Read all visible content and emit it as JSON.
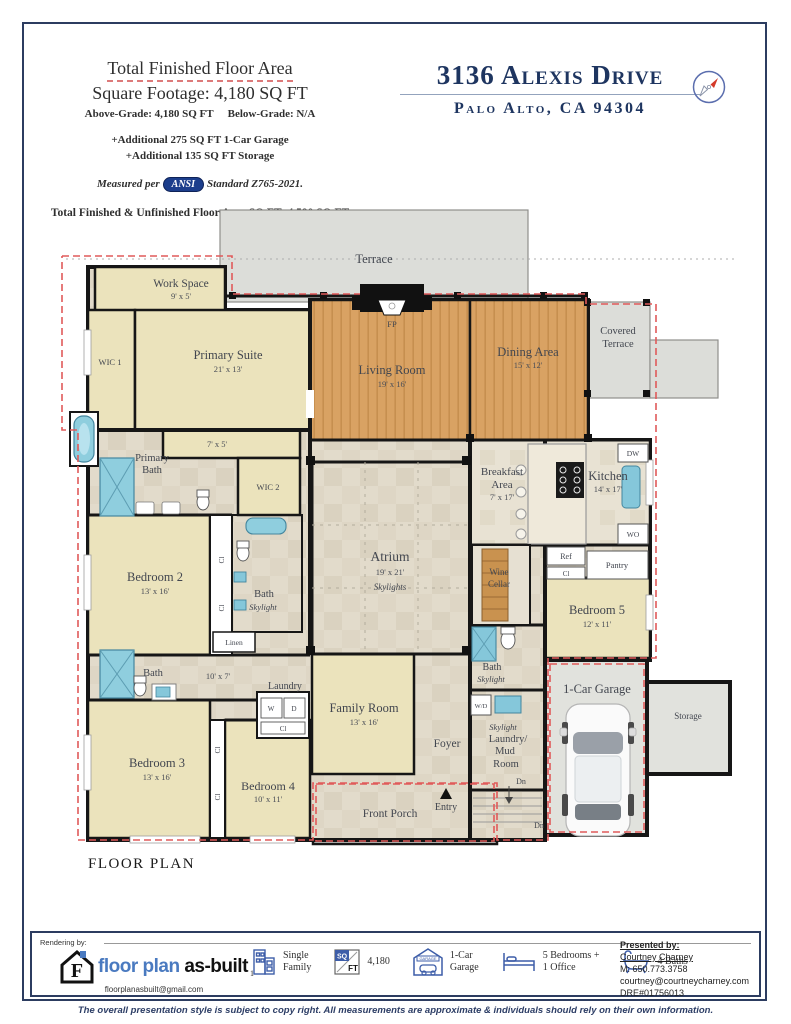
{
  "header": {
    "area_title": "Total Finished Floor Area",
    "area_value": "Square Footage: 4,180 SQ FT",
    "grade_above": "Above-Grade: 4,180 SQ FT",
    "grade_below": "Below-Grade: N/A",
    "additional_1": "+Additional 275 SQ FT 1-Car Garage",
    "additional_2": "+Additional 135 SQ FT Storage",
    "measured_prefix": "Measured per",
    "ansi": "ANSI",
    "measured_suffix": "Standard Z765-2021.",
    "total_line": "Total Finished & Unfinished Floor Area SQ FT: 4,590 SQ FT",
    "address": "3136 Alexis Drive",
    "city": "Palo Alto, CA 94304"
  },
  "plan": {
    "label": "FLOOR PLAN",
    "rooms": {
      "terrace": "Terrace",
      "covered1": "Covered",
      "covered2": "Terrace",
      "work": {
        "n": "Work Space",
        "d": "9' x 5'"
      },
      "wic1": "WIC 1",
      "primary": {
        "n": "Primary Suite",
        "d": "21' x 13'"
      },
      "living": {
        "n": "Living Room",
        "d": "19' x 16'"
      },
      "dining": {
        "n": "Dining Area",
        "d": "15' x 12'"
      },
      "fp": "FP",
      "pbath1": "Primary",
      "pbath2": "Bath",
      "hall75": "7' x 5'",
      "wic2": "WIC 2",
      "bed2": {
        "n": "Bedroom 2",
        "d": "13' x 16'"
      },
      "bathc1": "Bath",
      "bathc2": "Skylight",
      "linen": "Linen",
      "bathl": "Bath",
      "hall107": "10' x 7'",
      "laundry": "Laundry",
      "w": "W",
      "d": "D",
      "cl": "Cl",
      "bed3": {
        "n": "Bedroom 3",
        "d": "13' x 16'"
      },
      "bed4": {
        "n": "Bedroom 4",
        "d": "10' x 11'"
      },
      "family": {
        "n": "Family Room",
        "d": "13' x 16'"
      },
      "foyer": "Foyer",
      "porch": "Front Porch",
      "entry": "Entry",
      "atrium": {
        "n": "Atrium",
        "d": "19' x 21'",
        "s": "Skylights"
      },
      "breakfast": {
        "n1": "Breakfast",
        "n2": "Area",
        "d": "7' x 17'"
      },
      "kitchen": {
        "n": "Kitchen",
        "d": "14' x 17'"
      },
      "dw": "DW",
      "wo": "WO",
      "ref": "Ref",
      "pantry": "Pantry",
      "wine1": "Wine",
      "wine2": "Cellar",
      "bed5": {
        "n": "Bedroom 5",
        "d": "12' x 11'"
      },
      "bathr1": "Bath",
      "bathr2": "Skylight",
      "wd": "W/D",
      "mud": {
        "s": "Skylight",
        "l1": "Laundry/",
        "l2": "Mud",
        "l3": "Room"
      },
      "dn": "Dn",
      "garage": "1-Car Garage",
      "storage": "Storage"
    }
  },
  "footer": {
    "rendering_by": "Rendering by:",
    "logo": {
      "monogram": "F",
      "brand_blue": "floor plan",
      "brand_black": "as-built",
      "email": "floorplanasbuilt@gmail.com"
    },
    "stats": {
      "family": {
        "prefix": "1",
        "l1": "Single",
        "l2": "Family"
      },
      "sqft": {
        "sq": "SQ",
        "ft": "FT",
        "value": "4,180"
      },
      "garage": {
        "tag": "GARAGE",
        "l1": "1-Car",
        "l2": "Garage"
      },
      "beds": {
        "l1": "5 Bedrooms +",
        "l2": "1 Office"
      },
      "baths": {
        "l1": "4 Baths"
      }
    },
    "presented": {
      "heading": "Presented by:",
      "name": "Courtney Charney",
      "phone": "M: 650.773.3758",
      "email": "courtney@courtneycharney.com",
      "dre": "DRE#01756013"
    }
  },
  "copyright": "The overall presentation style is subject to copy right. All measurements are approximate & individuals should rely on their own information."
}
